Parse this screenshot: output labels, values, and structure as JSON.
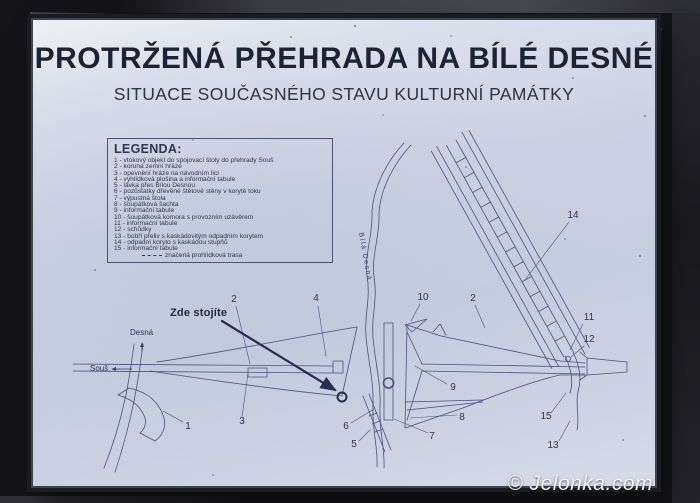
{
  "photo": {
    "watermark": "© Jelonka.com"
  },
  "colors": {
    "ink": "#2c3654",
    "line": "#46537c",
    "paper": "#ccd2e2",
    "frame": "#1b1c21"
  },
  "board": {
    "title": "PROTRŽENÁ PŘEHRADA NA BÍLÉ DESNÉ",
    "subtitle": "SITUACE SOUČASNÉHO STAVU KULTURNÍ PAMÁTKY"
  },
  "legend": {
    "heading": "LEGENDA:",
    "items": [
      "1 - vtokový objekt do spojovací štoly do přehrady Souš",
      "2 - koruna zemní hráze",
      "3 - opevnění hráze na návodním líci",
      "4 - vyhlídková plošina a informační tabule",
      "5 - lávka přes Bílou Desnou",
      "6 - pozůstatky dřevěné štětové stěny v korytě toku",
      "7 - výpustná štola",
      "8 - šoupátková šachta",
      "9 - informační tabule",
      "10 - šoupátková komora s provozním uzávěrem",
      "11 - informační tabule",
      "12 - schůdky",
      "13 - bobří přeliv s kaskádovitým odpadním korytem",
      "14 - odpadní koryto s kaskádou stupňů",
      "15 - informační tabule"
    ],
    "trail_note": "značená prohlídková trasa"
  },
  "map": {
    "you_are_here": "Zde stojíte",
    "river_label": "Bílá Desná",
    "directions": [
      {
        "text": "Desná"
      },
      {
        "text": "Souš"
      }
    ],
    "point_labels": [
      {
        "n": "1",
        "x": 155,
        "y": 407
      },
      {
        "n": "2",
        "x": 201,
        "y": 280
      },
      {
        "n": "3",
        "x": 209,
        "y": 402
      },
      {
        "n": "4",
        "x": 283,
        "y": 279
      },
      {
        "n": "5",
        "x": 321,
        "y": 425
      },
      {
        "n": "6",
        "x": 313,
        "y": 407
      },
      {
        "n": "7",
        "x": 399,
        "y": 417
      },
      {
        "n": "8",
        "x": 429,
        "y": 398
      },
      {
        "n": "9",
        "x": 420,
        "y": 368
      },
      {
        "n": "10",
        "x": 390,
        "y": 278
      },
      {
        "n": "11",
        "x": 556,
        "y": 298
      },
      {
        "n": "12",
        "x": 556,
        "y": 320
      },
      {
        "n": "13",
        "x": 520,
        "y": 426
      },
      {
        "n": "14",
        "x": 540,
        "y": 196
      },
      {
        "n": "15",
        "x": 513,
        "y": 397
      },
      {
        "n": "2",
        "x": 440,
        "y": 279
      }
    ]
  }
}
